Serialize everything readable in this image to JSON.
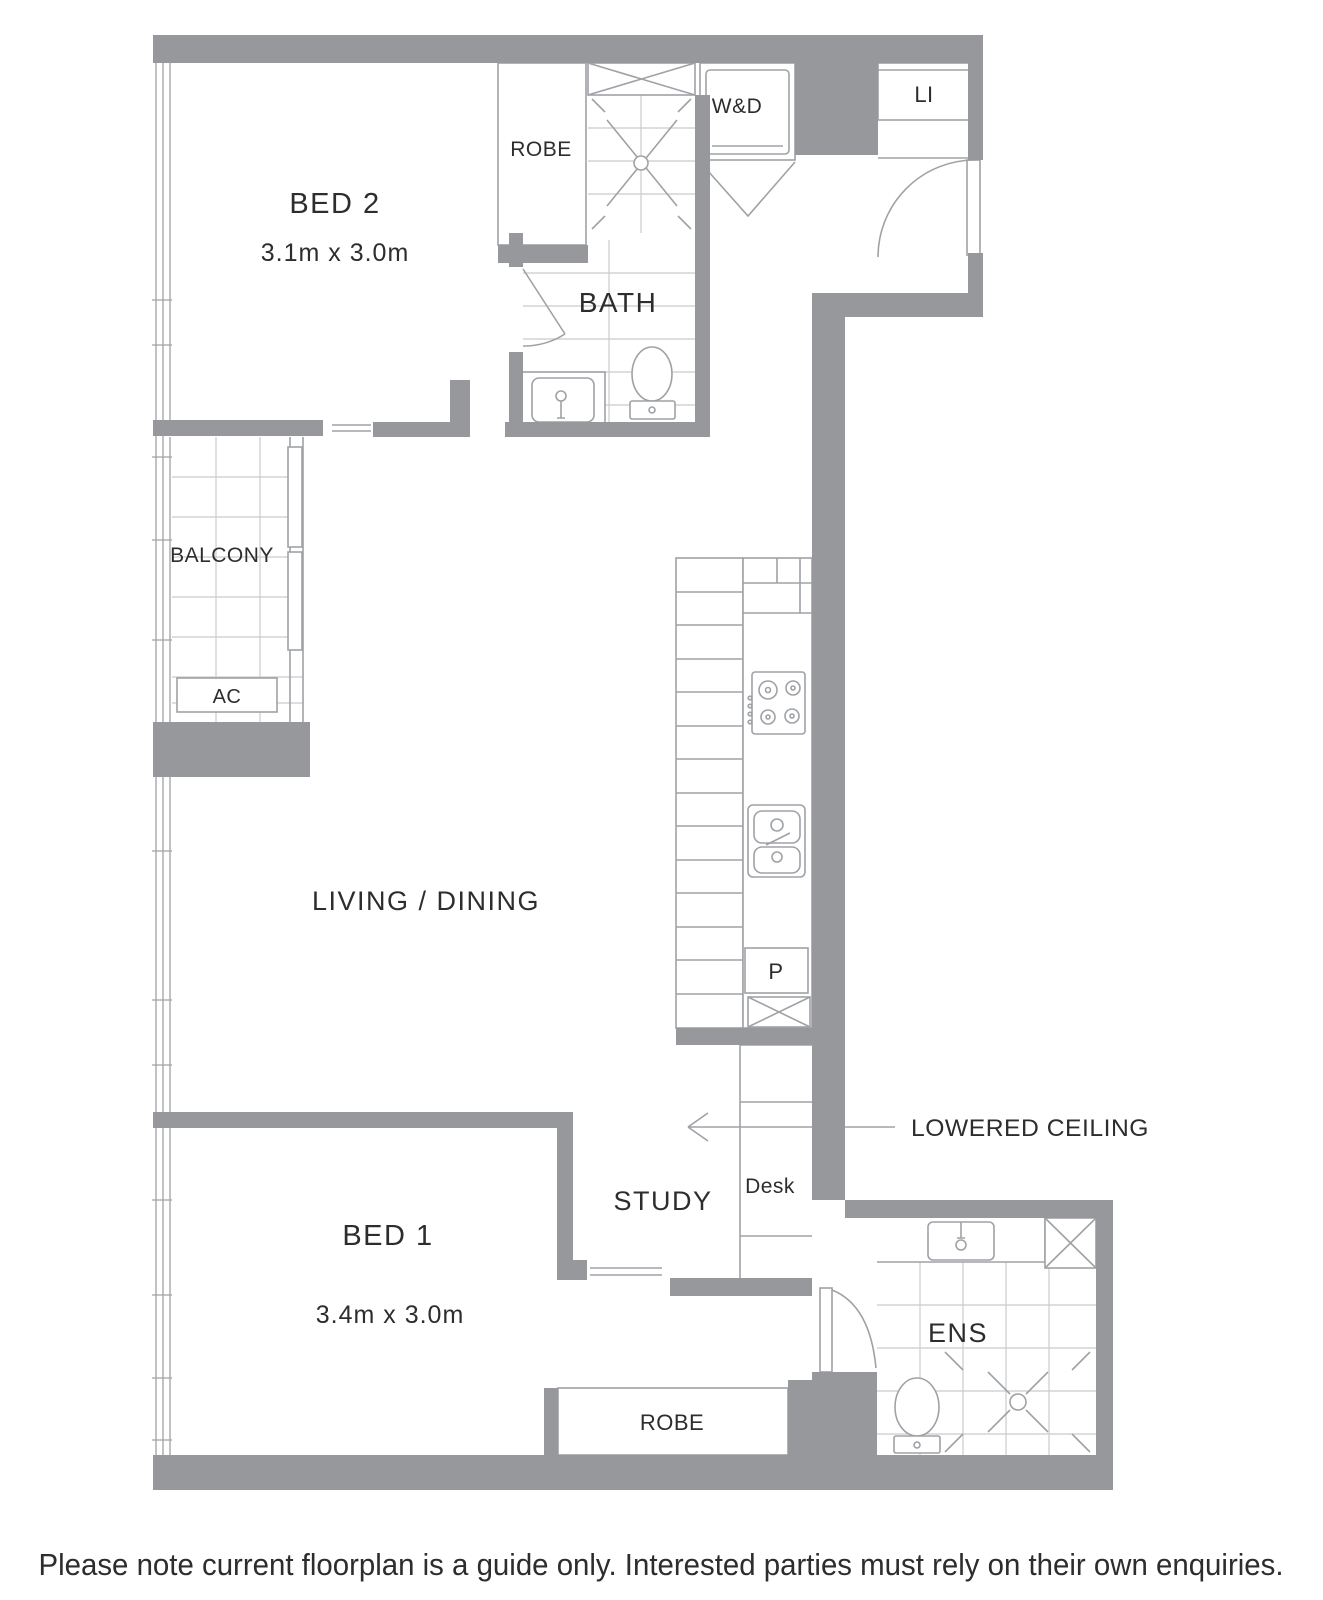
{
  "floorplan": {
    "rooms": {
      "bed2": {
        "name": "BED 2",
        "dims": "3.1m x 3.0m"
      },
      "bed1": {
        "name": "BED 1",
        "dims": "3.4m x 3.0m"
      },
      "living": {
        "name": "LIVING / DINING"
      },
      "bath": {
        "name": "BATH"
      },
      "ens": {
        "name": "ENS"
      },
      "study": {
        "name": "STUDY"
      },
      "balcony": {
        "name": "BALCONY"
      }
    },
    "features": {
      "robe_bed2": "ROBE",
      "robe_bed1": "ROBE",
      "washer_dryer": "W&D",
      "linen": "LI",
      "air_con": "AC",
      "pantry": "P",
      "desk": "Desk",
      "lowered_ceiling": "LOWERED CEILING"
    },
    "disclaimer": "Please note current floorplan is a guide only. Interested parties must rely on their own enquiries.",
    "colors": {
      "wall": "#96989b",
      "fixture_line": "#9fa2a5",
      "tile_line": "#c9cbcd",
      "text": "#2d2d2d"
    }
  }
}
